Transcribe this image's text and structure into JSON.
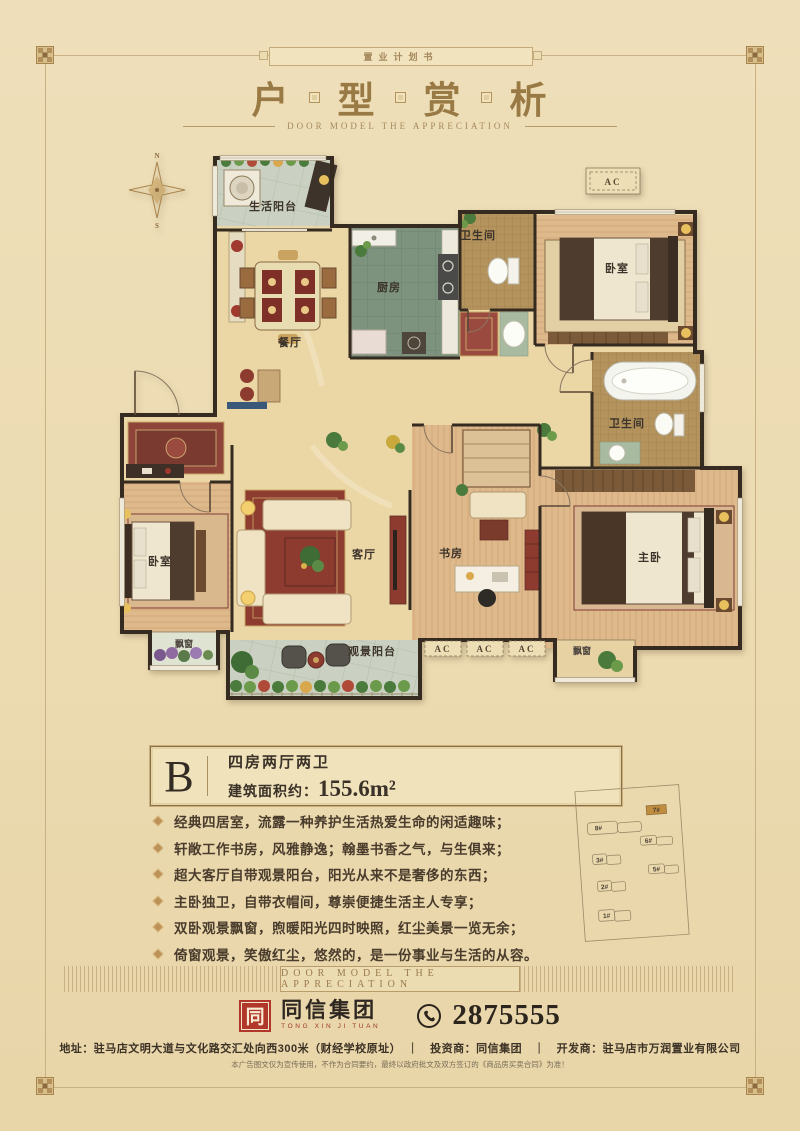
{
  "colors": {
    "background": "#ecdbb1",
    "accent_gold": "#9a7a44",
    "logo_red": "#b0372a",
    "highlight_orange": "#c08c3e",
    "wall": "#352b20"
  },
  "banner": {
    "text": "置业计划书"
  },
  "header": {
    "title_chars": [
      "户",
      "型",
      "赏",
      "析"
    ],
    "subtitle": "DOOR MODEL THE APPRECIATION"
  },
  "floorplan": {
    "compass_n": "N",
    "compass_s": "S",
    "ac_label": "AC",
    "rooms": {
      "life_balcony": "生活阳台",
      "dining": "餐厅",
      "kitchen": "厨房",
      "bath_top": "卫生间",
      "bedroom_top": "卧室",
      "bath_right": "卫生间",
      "living": "客厅",
      "bedroom_left": "卧室",
      "study": "书房",
      "master": "主卧",
      "view_balcony": "观景阳台",
      "bay_left": "飘窗",
      "bay_right": "飘窗"
    }
  },
  "unit": {
    "letter": "B",
    "layout": "四房两厅两卫",
    "area_label": "建筑面积约：",
    "area_value": "155.6m²"
  },
  "features": [
    "经典四居室，流露一种养护生活热爱生命的闲适趣味；",
    "轩敞工作书房，风雅静逸；翰墨书香之气，与生俱来；",
    "超大客厅自带观景阳台，阳光从来不是奢侈的东西；",
    "主卧独卫，自带衣帽间，尊崇便捷生活主人专享；",
    "双卧观景飘窗，煦暖阳光四时映照，红尘美景一览无余；",
    "倚窗观景，笑傲红尘，悠然的，是一份事业与生活的从容。"
  ],
  "siteplan": {
    "buildings": [
      "7#",
      "8#",
      "6#",
      "3#",
      "5#",
      "2#",
      "1#"
    ],
    "highlighted": "7#"
  },
  "band": {
    "text": "DOOR MODEL THE APPRECIATION"
  },
  "footer": {
    "logo_glyph": "同",
    "logo_name": "同信集团",
    "logo_sub": "TONG XIN JI TUAN",
    "phone": "2875555",
    "address_line": "地址：驻马店文明大道与文化路交汇处向西300米（财经学校原址）　｜　投资商：同信集团　｜　开发商：驻马店市万润置业有限公司",
    "disclaimer": "本广告图文仅为宣传使用，不作为合同要约，最终以政府批文及双方签订的《商品房买卖合同》为准！"
  }
}
